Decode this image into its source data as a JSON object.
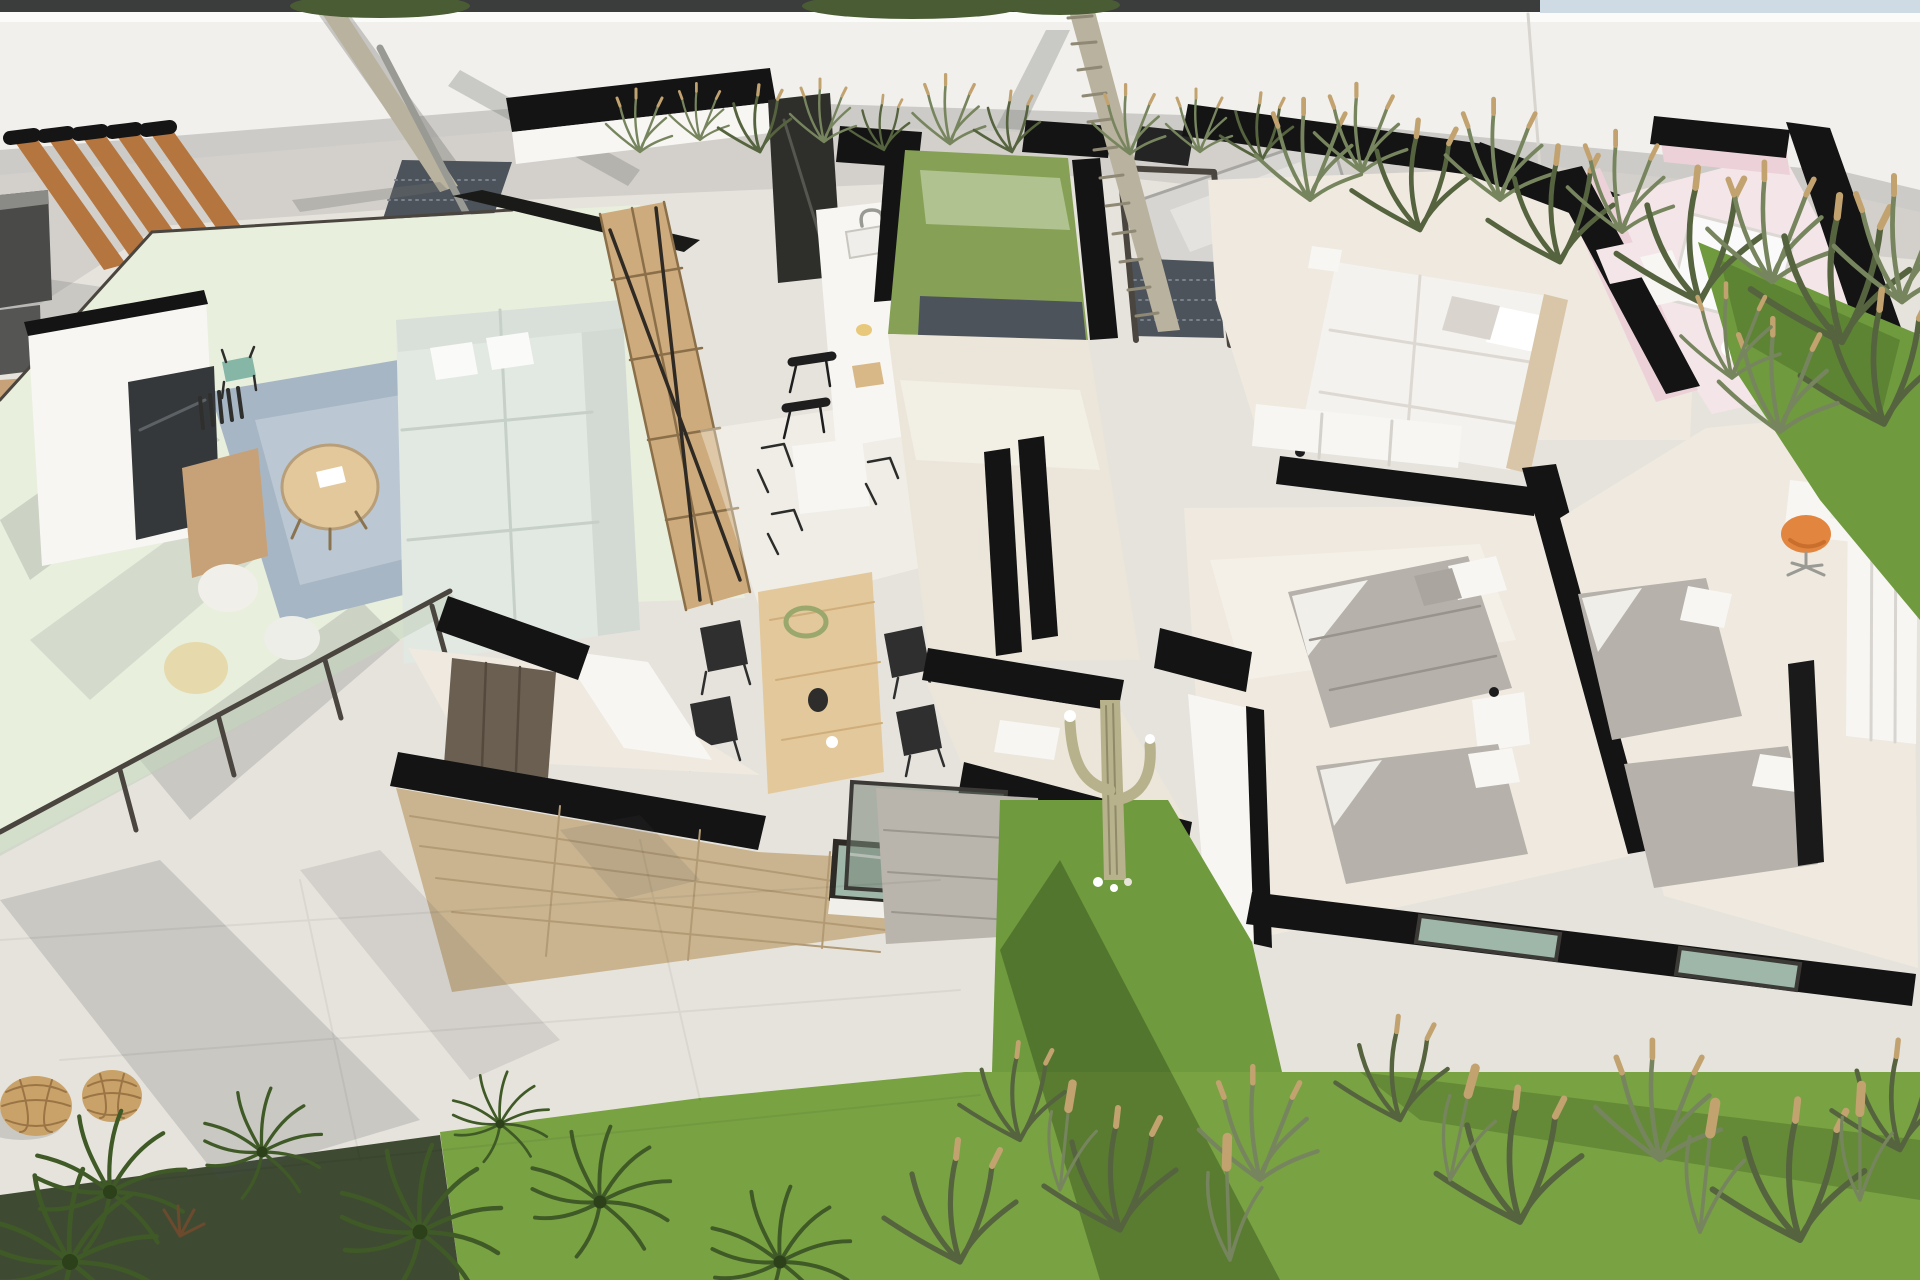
{
  "palette": {
    "cut_wall": "#141414",
    "wall_light": "#f1f0ed",
    "ground": "#e6e3dc",
    "pavement": "#efede7",
    "terrace_glass_tint": "#e9efdd",
    "interior_floor": "#efe9df",
    "hall_floor": "#ece6da",
    "white_surface": "#f7f6f3",
    "rug_blue": "#a7b6c4",
    "wood_light": "#e3c89b",
    "wood_mid": "#cdab7c",
    "wood_dark": "#c7a278",
    "pergola_wood": "#b5753f",
    "tv_screen": "#35383a",
    "sofa_mint": "#e2e8e2",
    "bed_gray": "#b6b1ab",
    "bed_white": "#f4f2ee",
    "pink_wall": "#ecd2d8",
    "pink_floor": "#f4e6e8",
    "lawn": "#79a243",
    "lawn_strip": "#6f9a3e",
    "grass_olive": "#77855e",
    "grass_dark": "#55633f",
    "seed_tan": "#c2a370",
    "stone_clad": "#c9b48f",
    "gravel": "#4d535b",
    "cactus": "#b7b28c",
    "orange_chair": "#e2853f",
    "palm_trunk": "#b9b29e",
    "lantern": "#c9a269",
    "plant_palm": "#3f5a26",
    "soil_dark": "#3f4a33",
    "sky": "#cfdbe4",
    "canopy": "#4a5c33",
    "glass_frame": "#4a453e",
    "window_glass": "#9fb7a8",
    "dark_cabinet": "#6b5f52",
    "metal": "#9a9a94"
  },
  "scene": {
    "type": "3d-floor-plan-render",
    "areas": [
      "perimeter-wall",
      "boundary-planting",
      "terrace-lounge",
      "pergola",
      "outdoor-kitchen",
      "living-room",
      "dining-area",
      "kitchen",
      "entry-courtyard",
      "palm-tree",
      "hallway",
      "master-bedroom",
      "bathroom-pink",
      "bedroom-2",
      "bedroom-3",
      "service-wing",
      "garden-lawn",
      "garden-path",
      "cactus-garden-strip"
    ],
    "furniture": [
      "tv-media-wall",
      "tv-screen",
      "sideboard",
      "coffee-table",
      "area-rug",
      "poufs",
      "sofa",
      "shelf-divider",
      "dining-table",
      "dining-chairs",
      "kitchen-island",
      "bar-stools",
      "kitchen-counter",
      "cooktop",
      "beds",
      "nightstand",
      "desk",
      "orange-swivel-chair",
      "wardrobe",
      "bathtub",
      "vanity",
      "rattan-lanterns"
    ]
  }
}
